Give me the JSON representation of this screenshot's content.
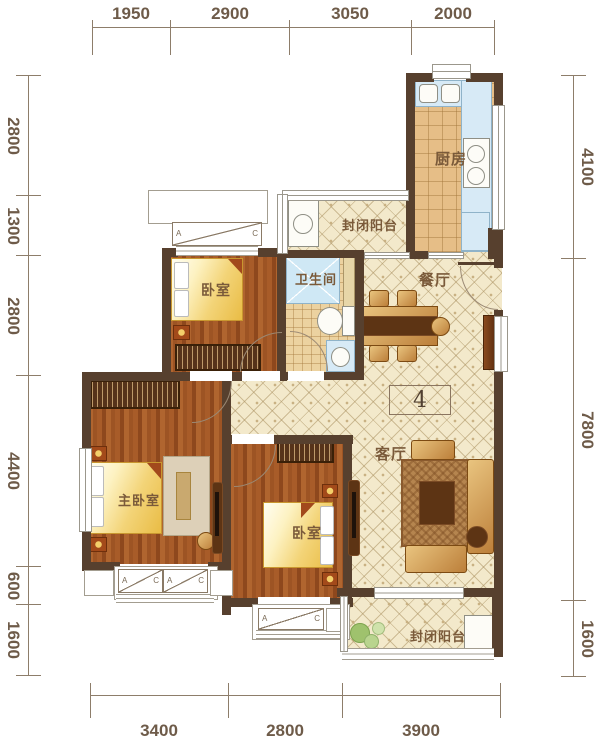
{
  "dimensions": {
    "top": [
      "1950",
      "2900",
      "3050",
      "2000"
    ],
    "left": [
      "2800",
      "1300",
      "2800",
      "4400",
      "600",
      "1600"
    ],
    "right": [
      "4100",
      "7800",
      "1600"
    ],
    "bottom": [
      "3400",
      "2800",
      "3900"
    ]
  },
  "rooms": {
    "kitchen": {
      "label": "厨房"
    },
    "balcony_top": {
      "label": "封闭阳台"
    },
    "dining": {
      "label": "餐厅"
    },
    "bathroom": {
      "label": "卫生间"
    },
    "bedroom_top": {
      "label": "卧室"
    },
    "master_bedroom": {
      "label": "主卧室"
    },
    "bedroom_second": {
      "label": "卧室"
    },
    "living": {
      "label": "客厅"
    },
    "balcony_bottom": {
      "label": "封闭阳台"
    }
  },
  "unit": {
    "number": "4"
  },
  "window_markers": {
    "a": "A",
    "c": "C"
  },
  "colors": {
    "wall": "#57402e",
    "floor_tile": "#f3e9cb",
    "wood_floor": "#a3582a",
    "bed_gold": "#eec85e",
    "counter_blue": "#d7eaf6",
    "dimension_text": "#6e5b49"
  }
}
